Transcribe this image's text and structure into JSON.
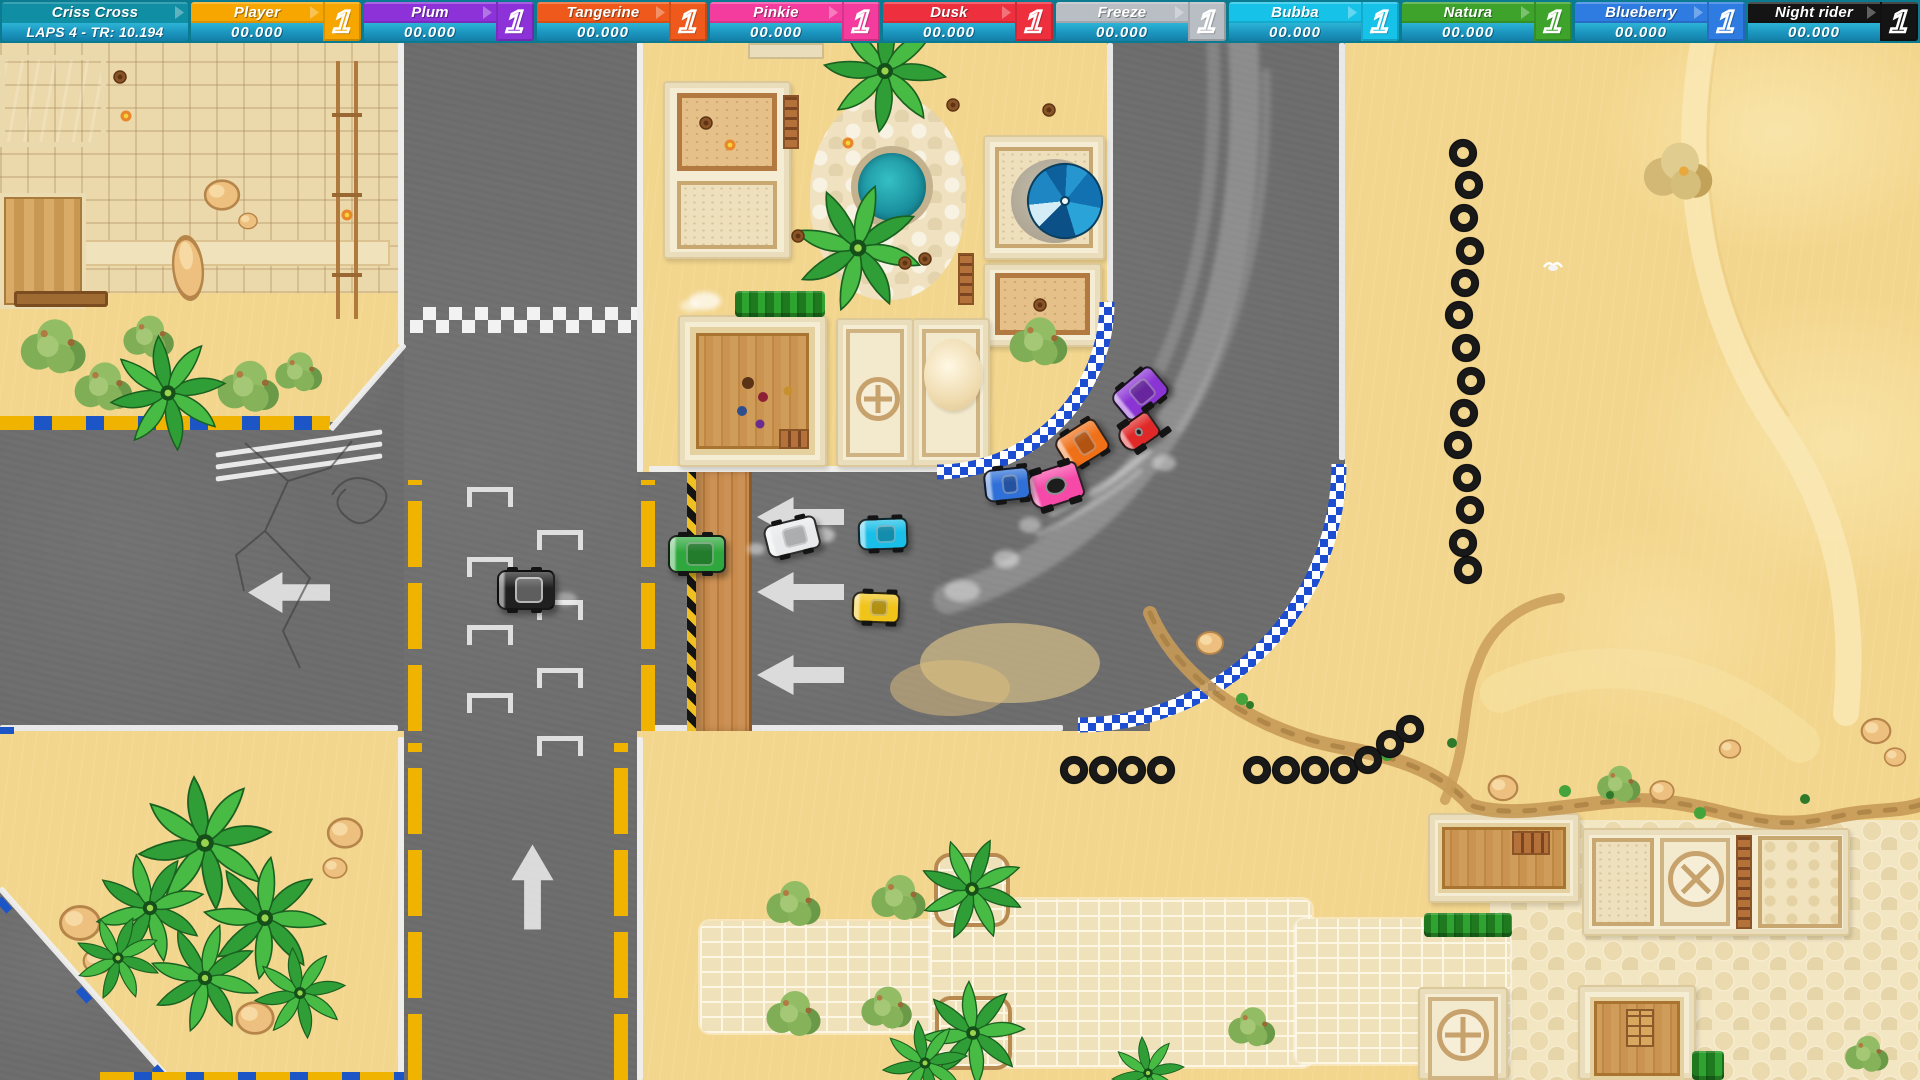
{
  "hud": {
    "track": {
      "name": "Criss Cross",
      "laps": "LAPS 4 - TR: 10.194"
    },
    "players": [
      {
        "name": "Player",
        "time": "00.000",
        "rank": "1",
        "color": "#f7a600"
      },
      {
        "name": "Plum",
        "time": "00.000",
        "rank": "1",
        "color": "#8c32d8"
      },
      {
        "name": "Tangerine",
        "time": "00.000",
        "rank": "1",
        "color": "#ef5a1c"
      },
      {
        "name": "Pinkie",
        "time": "00.000",
        "rank": "1",
        "color": "#f43c9e"
      },
      {
        "name": "Dusk",
        "time": "00.000",
        "rank": "1",
        "color": "#ee2f3e"
      },
      {
        "name": "Freeze",
        "time": "00.000",
        "rank": "1",
        "color": "#b9bec4"
      },
      {
        "name": "Bubba",
        "time": "00.000",
        "rank": "1",
        "color": "#17c2e9"
      },
      {
        "name": "Natura",
        "time": "00.000",
        "rank": "1",
        "color": "#3da32b"
      },
      {
        "name": "Blueberry",
        "time": "00.000",
        "rank": "1",
        "color": "#2e7ce2"
      },
      {
        "name": "Night rider",
        "time": "00.000",
        "rank": "1",
        "color": "#141414"
      }
    ]
  },
  "map": {
    "palette": {
      "sand": "#f3d68d",
      "asphalt": "#6e6e6e",
      "white_line": "#efefef",
      "curb_yellow": "#f0b400",
      "curb_blue": "#1c55c6",
      "checker_blue": "#1d4ed2",
      "plaza_tile": "#ecd9ab",
      "brick": "#efe1b9",
      "cobble": "#f3e6c3",
      "wall": "#f4edd3",
      "wall_edge": "#dcc99b",
      "wood": "#c8904f",
      "pool": "#1da4c8",
      "hedge": "#2b9a2e"
    },
    "cars": [
      {
        "player": "Player",
        "color": "#f0c419"
      },
      {
        "player": "Plum",
        "color": "#8b34d4"
      },
      {
        "player": "Tangerine",
        "color": "#f07018"
      },
      {
        "player": "Pinkie",
        "color": "#f649a8"
      },
      {
        "player": "Dusk",
        "color": "#e02828"
      },
      {
        "player": "Freeze",
        "color": "#e9eaec"
      },
      {
        "player": "Bubba",
        "color": "#19bfe8"
      },
      {
        "player": "Natura",
        "color": "#2ea83c"
      },
      {
        "player": "Blueberry",
        "color": "#2e6fd8"
      },
      {
        "player": "Night rider",
        "color": "#202020"
      }
    ]
  }
}
